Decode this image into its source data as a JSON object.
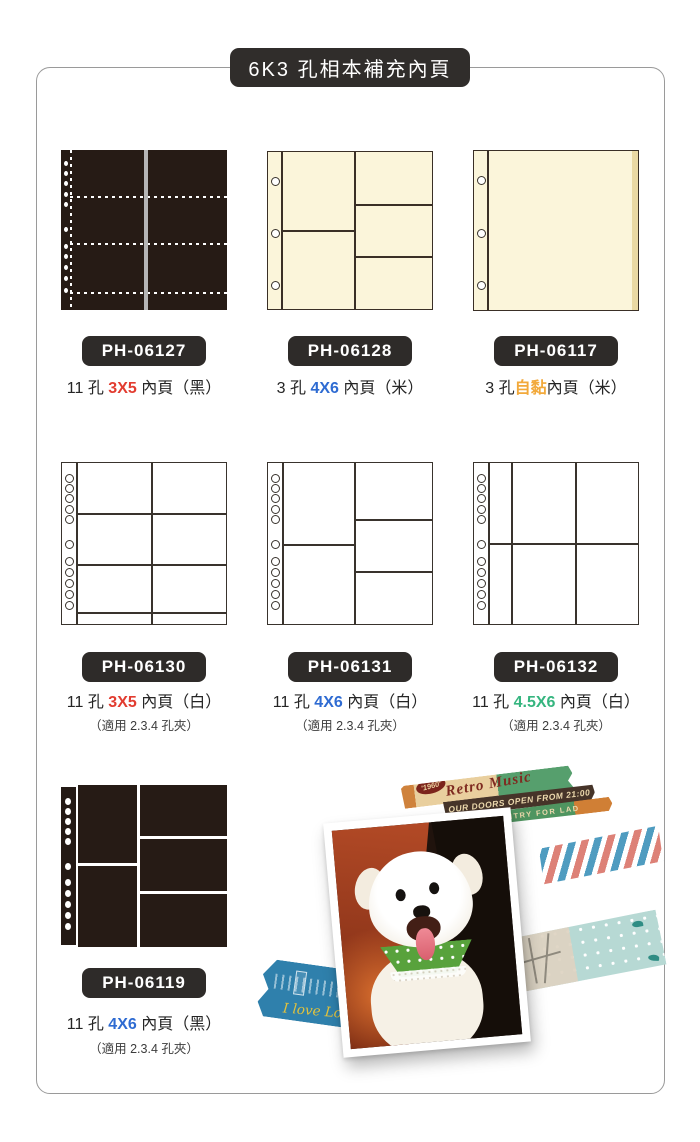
{
  "title": "6K3 孔相本補充內頁",
  "products": [
    {
      "code": "PH-06127",
      "prefix": "11 孔 ",
      "size": "3X5",
      "size_color": "#e23c30",
      "suffix": " 內頁（黑）"
    },
    {
      "code": "PH-06128",
      "prefix": "3 孔 ",
      "size": "4X6",
      "size_color": "#2e6bd2",
      "suffix": " 內頁（米）"
    },
    {
      "code": "PH-06117",
      "prefix": "3 孔",
      "size": "自黏",
      "size_color": "#f2a93b",
      "suffix": "內頁（米）"
    },
    {
      "code": "PH-06130",
      "prefix": "11 孔 ",
      "size": "3X5",
      "size_color": "#e23c30",
      "suffix": " 內頁（白）",
      "note": "（適用 2.3.4 孔夾）"
    },
    {
      "code": "PH-06131",
      "prefix": "11 孔 ",
      "size": "4X6",
      "size_color": "#2e6bd2",
      "suffix": " 內頁（白）",
      "note": "（適用 2.3.4 孔夾）"
    },
    {
      "code": "PH-06132",
      "prefix": "11 孔 ",
      "size": "4.5X6",
      "size_color": "#35b57f",
      "suffix": " 內頁（白）",
      "note": "（適用 2.3.4 孔夾）"
    },
    {
      "code": "PH-06119",
      "prefix": "11 孔 ",
      "size": "4X6",
      "size_color": "#2e6bd2",
      "suffix": " 內頁（黑）",
      "note": "（適用 2.3.4 孔夾）"
    }
  ],
  "collage": {
    "ticket_badge": "'1960'",
    "ticket_title": "Retro Music",
    "ticket_line2": "OUR DOORS OPEN FROM 21:00",
    "ticket_line3": "ENTRY FOR LAD",
    "london_text": "I love London"
  },
  "colors": {
    "frame_border": "#9a9a9a",
    "badge_bg": "#2e2b29",
    "page_black": "#261b15",
    "page_cream": "#fbf5da",
    "accent_red": "#e23c30",
    "accent_blue": "#2e6bd2",
    "accent_green": "#35b57f",
    "accent_orange": "#f2a93b"
  }
}
